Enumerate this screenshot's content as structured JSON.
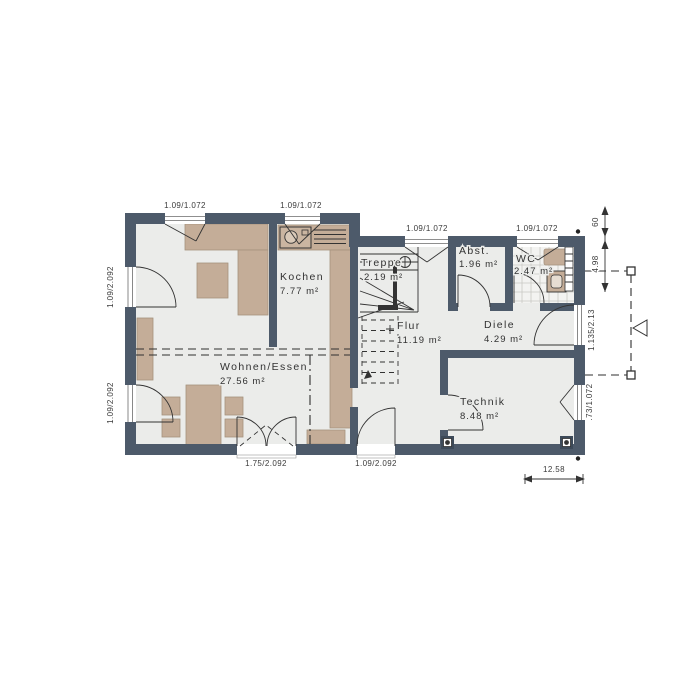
{
  "plan": {
    "type": "floor-plan-ground-floor",
    "rooms": {
      "wohnen": {
        "name": "Wohnen/Essen",
        "area": "27.56 m²"
      },
      "kochen": {
        "name": "Kochen",
        "area": "7.77 m²"
      },
      "treppe": {
        "name": "Treppe",
        "area": "2.19 m²"
      },
      "abst": {
        "name": "Abst.",
        "area": "1.96 m²"
      },
      "wc": {
        "name": "WC",
        "area": "2.47 m²"
      },
      "flur": {
        "name": "Flur",
        "area": "11.19 m²"
      },
      "diele": {
        "name": "Diele",
        "area": "4.29 m²"
      },
      "technik": {
        "name": "Technik",
        "area": "8.48 m²"
      }
    },
    "openings": {
      "window_top_1": "1.09/1.072",
      "window_top_2": "1.09/1.072",
      "window_top_3": "1.09/1.072",
      "window_top_4": "1.09/1.072",
      "door_left_1": "1.09/2.092",
      "door_left_2": "1.09/2.092",
      "door_bottom_1": "1.75/2.092",
      "door_bottom_2": "1.09/2.092",
      "door_entrance": "1.135/2.13",
      "window_right": ".73/1.072"
    },
    "dimensions": {
      "right_top": "60",
      "right_mid": "4.98",
      "bottom_right": "12.58"
    },
    "colors": {
      "wall": "#4d5a6a",
      "floor": "#ebecea",
      "furniture": "#c4ad98",
      "background": "#ffffff",
      "line": "#333333"
    }
  }
}
